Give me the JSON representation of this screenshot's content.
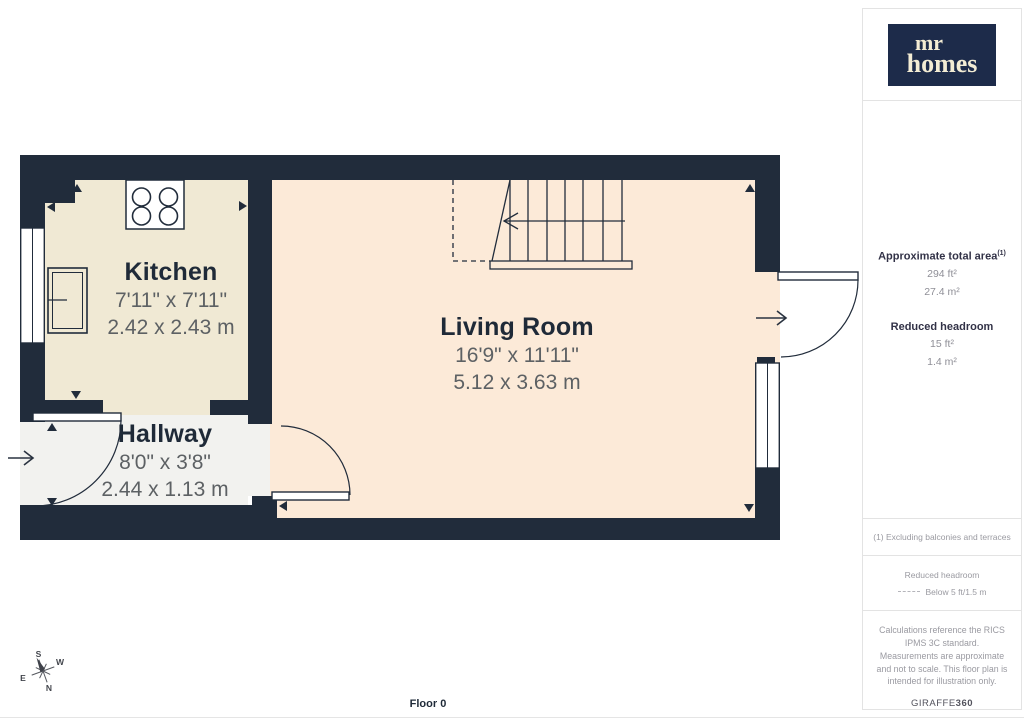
{
  "branding": {
    "logo_top": "mr",
    "logo_bottom": "homes"
  },
  "plan": {
    "floor_label": "Floor 0",
    "rooms": [
      {
        "name": "Kitchen",
        "imperial": "7'11\" x 7'11\"",
        "metric": "2.42 x 2.43 m"
      },
      {
        "name": "Living Room",
        "imperial": "16'9\" x 11'11\"",
        "metric": "5.12 x 3.63 m"
      },
      {
        "name": "Hallway",
        "imperial": "8'0\" x 3'8\"",
        "metric": "2.44 x 1.13 m"
      }
    ],
    "compass": {
      "n": "N",
      "s": "S",
      "e": "E",
      "w": "W"
    },
    "icons": [
      "compass-rose",
      "entry-arrow",
      "staircase",
      "cooktop",
      "sink",
      "door-swing",
      "window"
    ]
  },
  "sidebar": {
    "area_title": "Approximate total area",
    "area_footnote_marker": "(1)",
    "area_imperial": "294 ft²",
    "area_metric": "27.4 m²",
    "headroom_title": "Reduced headroom",
    "headroom_imperial": "15 ft²",
    "headroom_metric": "1.4 m²",
    "footnote": "(1) Excluding balconies and terraces",
    "legend_title": "Reduced headroom",
    "legend_value": "Below 5 ft/1.5 m",
    "disclaimer": "Calculations reference the RICS IPMS 3C standard. Measurements are approximate and not to scale. This floor plan is intended for illustration only.",
    "provider": "GIRAFFE",
    "provider_suffix": "360"
  },
  "colors": {
    "wall": "#212c3b",
    "kitchen_floor": "#f0e9d4",
    "living_floor": "#fcead8",
    "hallway_floor": "#f2f2ef",
    "logo_bg": "#1d2b4a",
    "logo_text": "#f3ecd4"
  }
}
